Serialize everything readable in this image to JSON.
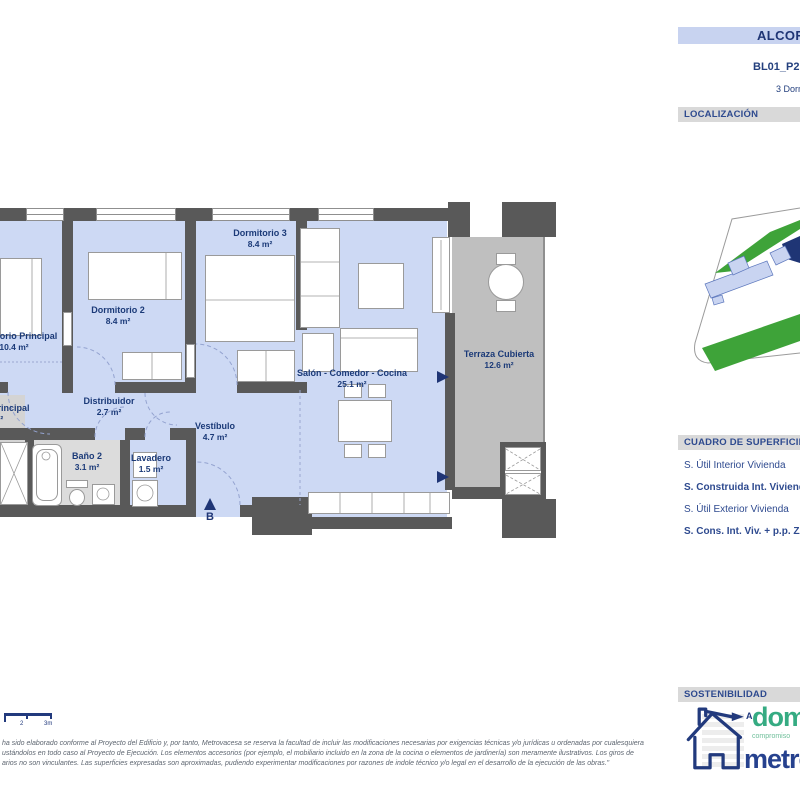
{
  "header": {
    "project_title": "ALCORA",
    "unit_code": "BL01_P2",
    "unit_type": "3 Dormitorios"
  },
  "sections": {
    "localizacion": "LOCALIZACIÓN",
    "superficies": "CUADRO DE SUPERFICIES",
    "sostenibilidad": "SOSTENIBILIDAD"
  },
  "surfaces": {
    "rows": [
      {
        "label": "S. Útil Interior Vivienda",
        "bold": false
      },
      {
        "label": "S. Construida Int. Vivienda",
        "bold": true
      },
      {
        "label": "S. Útil Exterior Vivienda",
        "bold": false
      },
      {
        "label": "S. Cons. Int. Viv. + p.p. ZZCC",
        "bold": true
      }
    ]
  },
  "floorplan": {
    "entry_marker": "B",
    "rooms": {
      "principal": {
        "name": "Dormitorio Principal",
        "area": "10.4 m²"
      },
      "dorm2": {
        "name": "Dormitorio 2",
        "area": "8.4 m²"
      },
      "dorm3": {
        "name": "Dormitorio 3",
        "area": "8.4 m²"
      },
      "distribuidor": {
        "name": "Distribuidor",
        "area": "2.7 m²"
      },
      "vestibulo": {
        "name": "Vestíbulo",
        "area": "4.7 m²"
      },
      "salon": {
        "name": "Salón - Comedor - Cocina",
        "area": "25.1 m²"
      },
      "terraza": {
        "name": "Terraza Cubierta",
        "area": "12.6 m²"
      },
      "bano_ppal": {
        "name": "Baño Principal",
        "area": "m²"
      },
      "bano2": {
        "name": "Baño 2",
        "area": "3.1 m²"
      },
      "lavadero": {
        "name": "Lavadero",
        "area": "1.5 m²"
      }
    }
  },
  "scalebar": {
    "labels": [
      "2",
      "3m"
    ]
  },
  "sustainability": {
    "energy_rating": "A",
    "brand_green": "domum",
    "brand_green_sub": "compromiso",
    "brand_blue": "metrovacesa"
  },
  "disclaimer": {
    "lines": [
      "ha sido elaborado conforme al Proyecto del Edificio y, por tanto, Metrovacesa se reserva la facultad de incluir las modificaciones necesarias por exigencias técnicas y/o jurídicas u ordenadas por cualesquiera",
      "ustándolos en todo caso al Proyecto de Ejecución. Los elementos accesorios (por ejemplo, el mobiliario incluido en la zona de la cocina o elementos de jardinería) son meramente ilustrativos. Los giros de",
      "arios no son vinculantes. Las superficies expresadas son aproximadas, pudiendo experimentar modificaciones por razones de indole técnico y/o legal en el desarrollo de la ejecución de las obras.\""
    ]
  },
  "colors": {
    "navy": "#1f3575",
    "header_bg": "#c8d3f0",
    "section_bar_bg": "#d9d9d9",
    "wall": "#595959",
    "floor_blue": "#cdd9f4",
    "terrace_gray": "#bfbfbf",
    "map_green": "#3ea339",
    "brand_green": "#35ab82",
    "brand_blue": "#26418e"
  }
}
